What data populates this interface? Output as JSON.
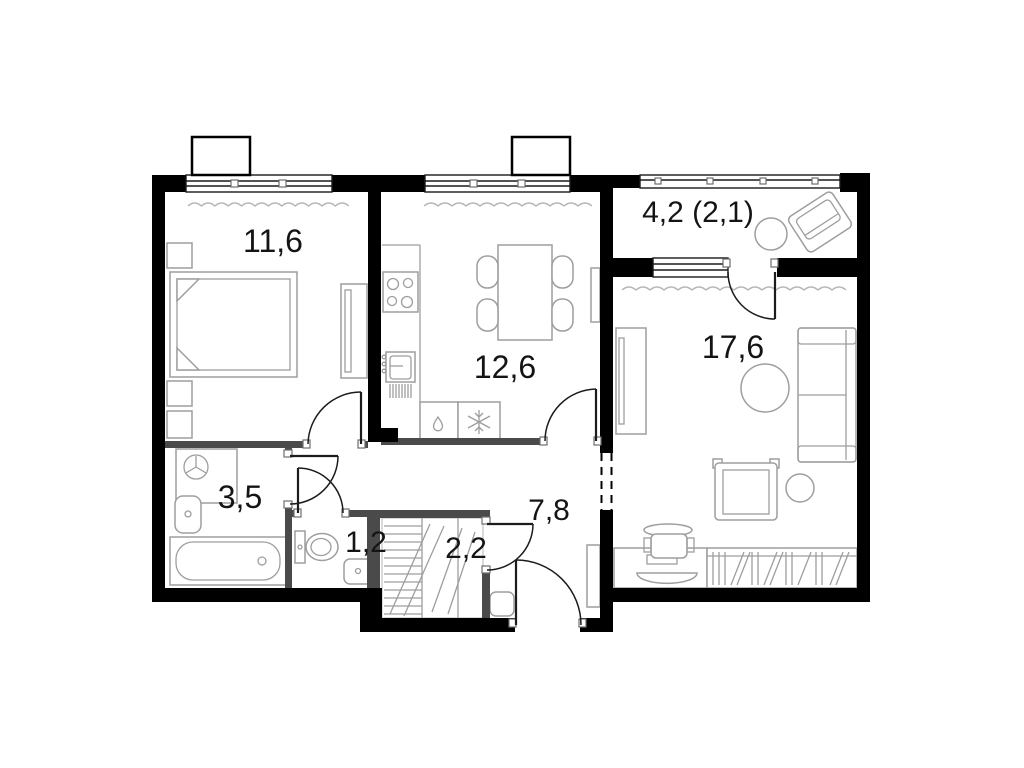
{
  "plan": {
    "title": "apartment-floor-plan",
    "rooms": {
      "bedroom": {
        "area": "11,6"
      },
      "kitchen": {
        "area": "12,6"
      },
      "balcony": {
        "area": "4,2 (2,1)"
      },
      "living_room": {
        "area": "17,6"
      },
      "bathroom": {
        "area": "3,5"
      },
      "toilet": {
        "area": "1,2"
      },
      "closet": {
        "area": "2,2"
      },
      "hallway": {
        "area": "7,8"
      }
    },
    "colors": {
      "wall": "#000000",
      "partition": "#4a4a4a",
      "furniture": "#9e9e9e",
      "label": "#141414",
      "background": "#ffffff"
    }
  }
}
